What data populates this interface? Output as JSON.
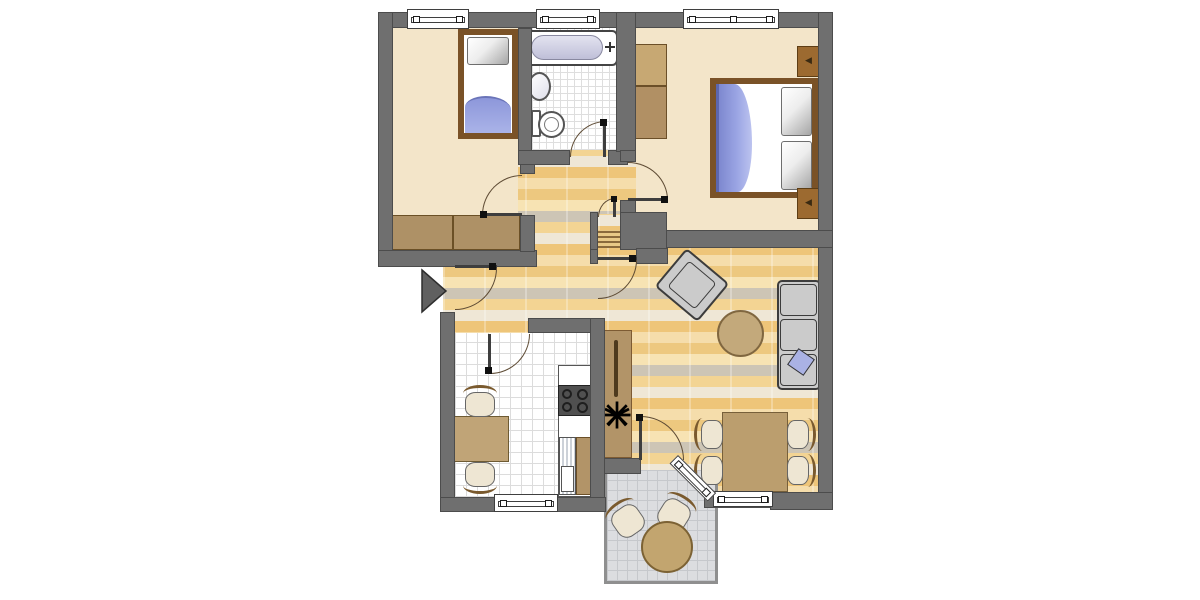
{
  "app": {
    "name": "apartment-floor-plan",
    "description": "2.5-room apartment floor plan, top view, no text labels"
  },
  "colors": {
    "wall": "#6f6f6f",
    "wall_outline": "#4c4c4c",
    "bedroom_floor": "#f3e5c9",
    "parquet_base": "#f2d8a0",
    "kitchen_tile": "#ffffff",
    "bath_tile": "#ffffff",
    "balcony_tile": "#dcdde0",
    "furniture_brown": "#ae9166",
    "bed_frame": "#7a5227",
    "blanket_blue": "#96a0de",
    "sofa_gray": "#cbcbcb",
    "table_tan": "#c3a97b",
    "door_arc": "#5d4a33",
    "entrance_arrow": "#606060"
  },
  "glyphs": {
    "lamp": "◀"
  },
  "entrance": {
    "symbol": "arrow-right",
    "side": "left"
  },
  "rooms": {
    "bedroom1": {
      "name": "Bedroom top-left",
      "floor": "beige",
      "furniture": [
        "single-bed",
        "wardrobe"
      ],
      "windows": 1,
      "doors": 1
    },
    "bathroom": {
      "name": "Bathroom",
      "floor": "white-tile",
      "furniture": [
        "bathtub",
        "sink",
        "toilet"
      ],
      "windows": 1,
      "doors": 1
    },
    "bedroom2": {
      "name": "Bedroom top-right",
      "floor": "beige",
      "furniture": [
        "double-bed",
        "wardrobe",
        "nightstand-top",
        "nightstand-bottom"
      ],
      "windows": 1,
      "doors": 1
    },
    "hallway": {
      "name": "Hallway",
      "floor": "parquet",
      "furniture": [
        "storage-closet-with-shelves"
      ],
      "windows": 0,
      "doors": 5
    },
    "kitchen": {
      "name": "Kitchen",
      "floor": "white-tile",
      "furniture": [
        "dining-table-small",
        "chair",
        "chair",
        "counter",
        "stove-4-burners",
        "sink-unit",
        "cabinet"
      ],
      "windows": 1,
      "doors": 1
    },
    "living": {
      "name": "Living room",
      "floor": "parquet",
      "furniture": [
        "armchair",
        "coffee-table-round",
        "sofa-3-seat",
        "blue-cushion",
        "sideboard",
        "plant",
        "dining-table",
        "chair",
        "chair",
        "chair",
        "chair"
      ],
      "windows": 2,
      "doors": 2
    },
    "balcony": {
      "name": "Balcony",
      "floor": "gray-tile",
      "furniture": [
        "chair",
        "chair",
        "table-round"
      ],
      "windows": 0,
      "doors": 1
    }
  }
}
